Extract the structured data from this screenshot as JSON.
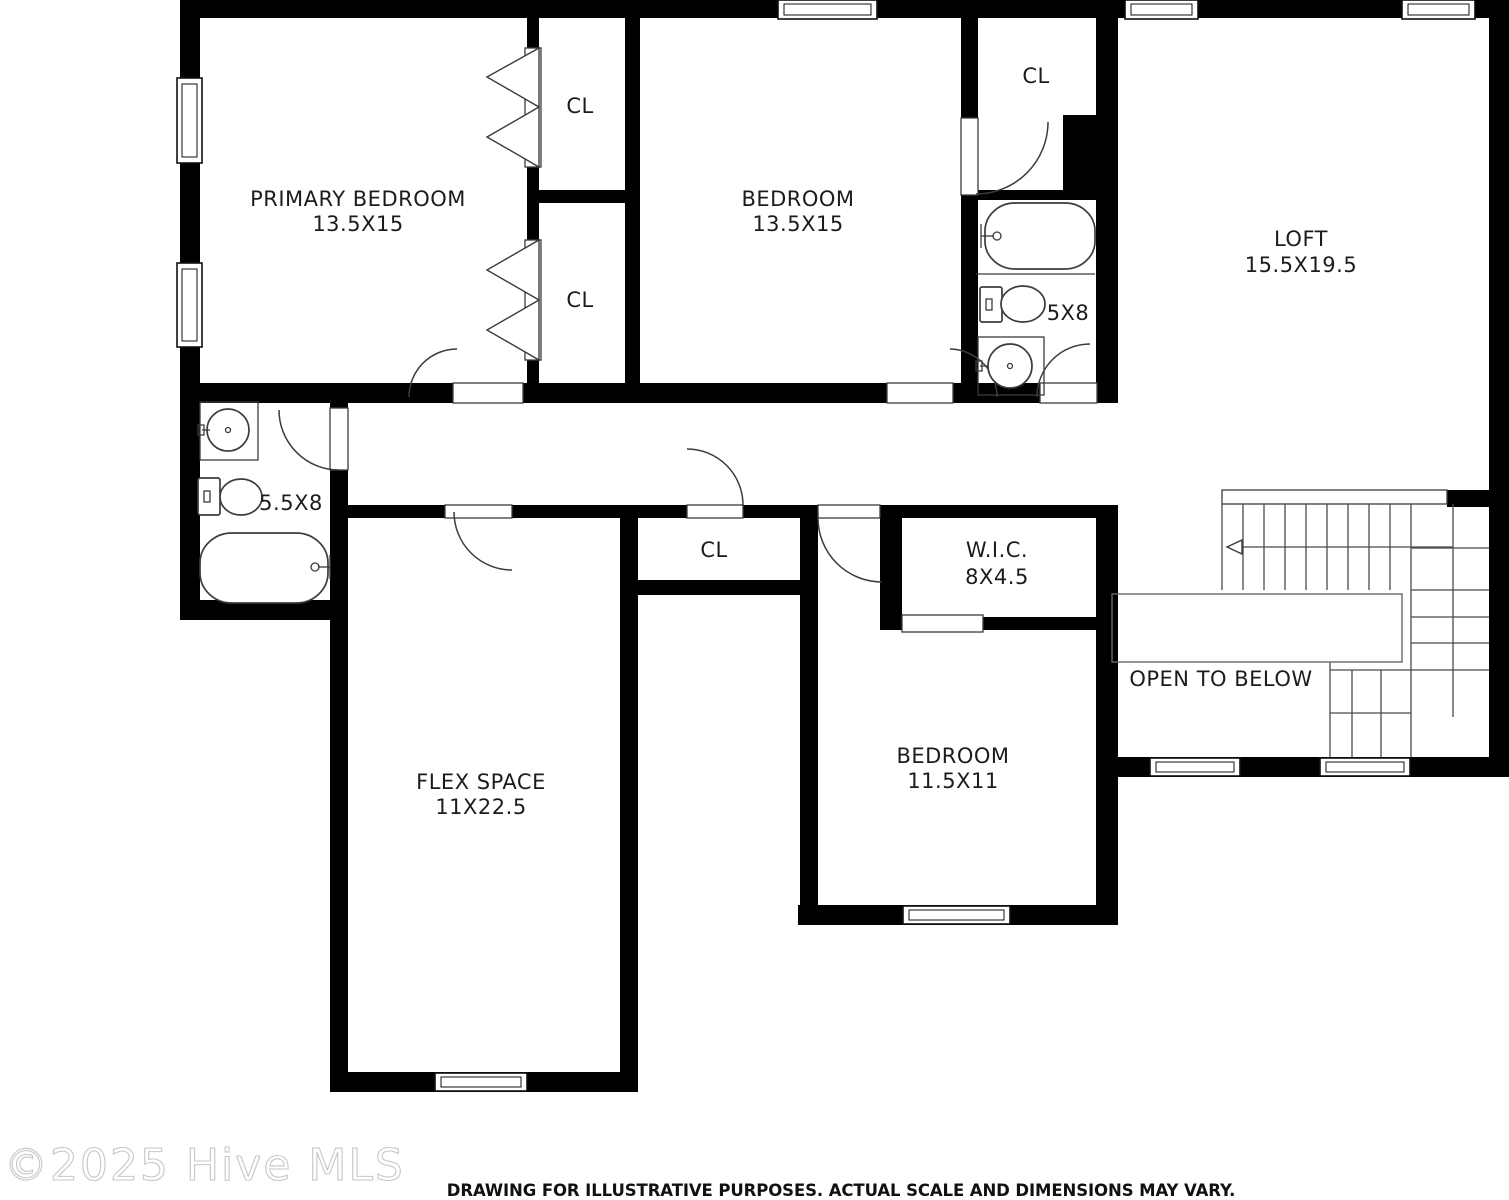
{
  "page": {
    "watermark": "©2025 Hive MLS",
    "disclaimer": "DRAWING FOR ILLUSTRATIVE PURPOSES. ACTUAL SCALE AND DIMENSIONS MAY VARY."
  },
  "rooms": {
    "primary_bedroom": {
      "name": "PRIMARY BEDROOM",
      "dims": "13.5X15"
    },
    "bedroom_upper": {
      "name": "BEDROOM",
      "dims": "13.5X15"
    },
    "loft": {
      "name": "LOFT",
      "dims": "15.5X19.5"
    },
    "flex_space": {
      "name": "FLEX SPACE",
      "dims": "11X22.5"
    },
    "bedroom_lower": {
      "name": "BEDROOM",
      "dims": "11.5X11"
    },
    "wic": {
      "name": "W.I.C.",
      "dims": "8X4.5"
    },
    "hall_bath": {
      "dims": "5X8"
    },
    "primary_bath": {
      "dims": "5.5X8"
    },
    "open_to_below": {
      "name": "OPEN TO BELOW"
    },
    "closets": {
      "primary_closet_top": "CL",
      "primary_closet_bottom": "CL",
      "hall_bath_closet": "CL",
      "hallway_closet": "CL"
    }
  },
  "colors": {
    "wall": "#000000",
    "fixture_line": "#3c3c3c",
    "label_text": "#1c1c1c",
    "watermark": "#c7c7c7",
    "background": "#ffffff"
  }
}
